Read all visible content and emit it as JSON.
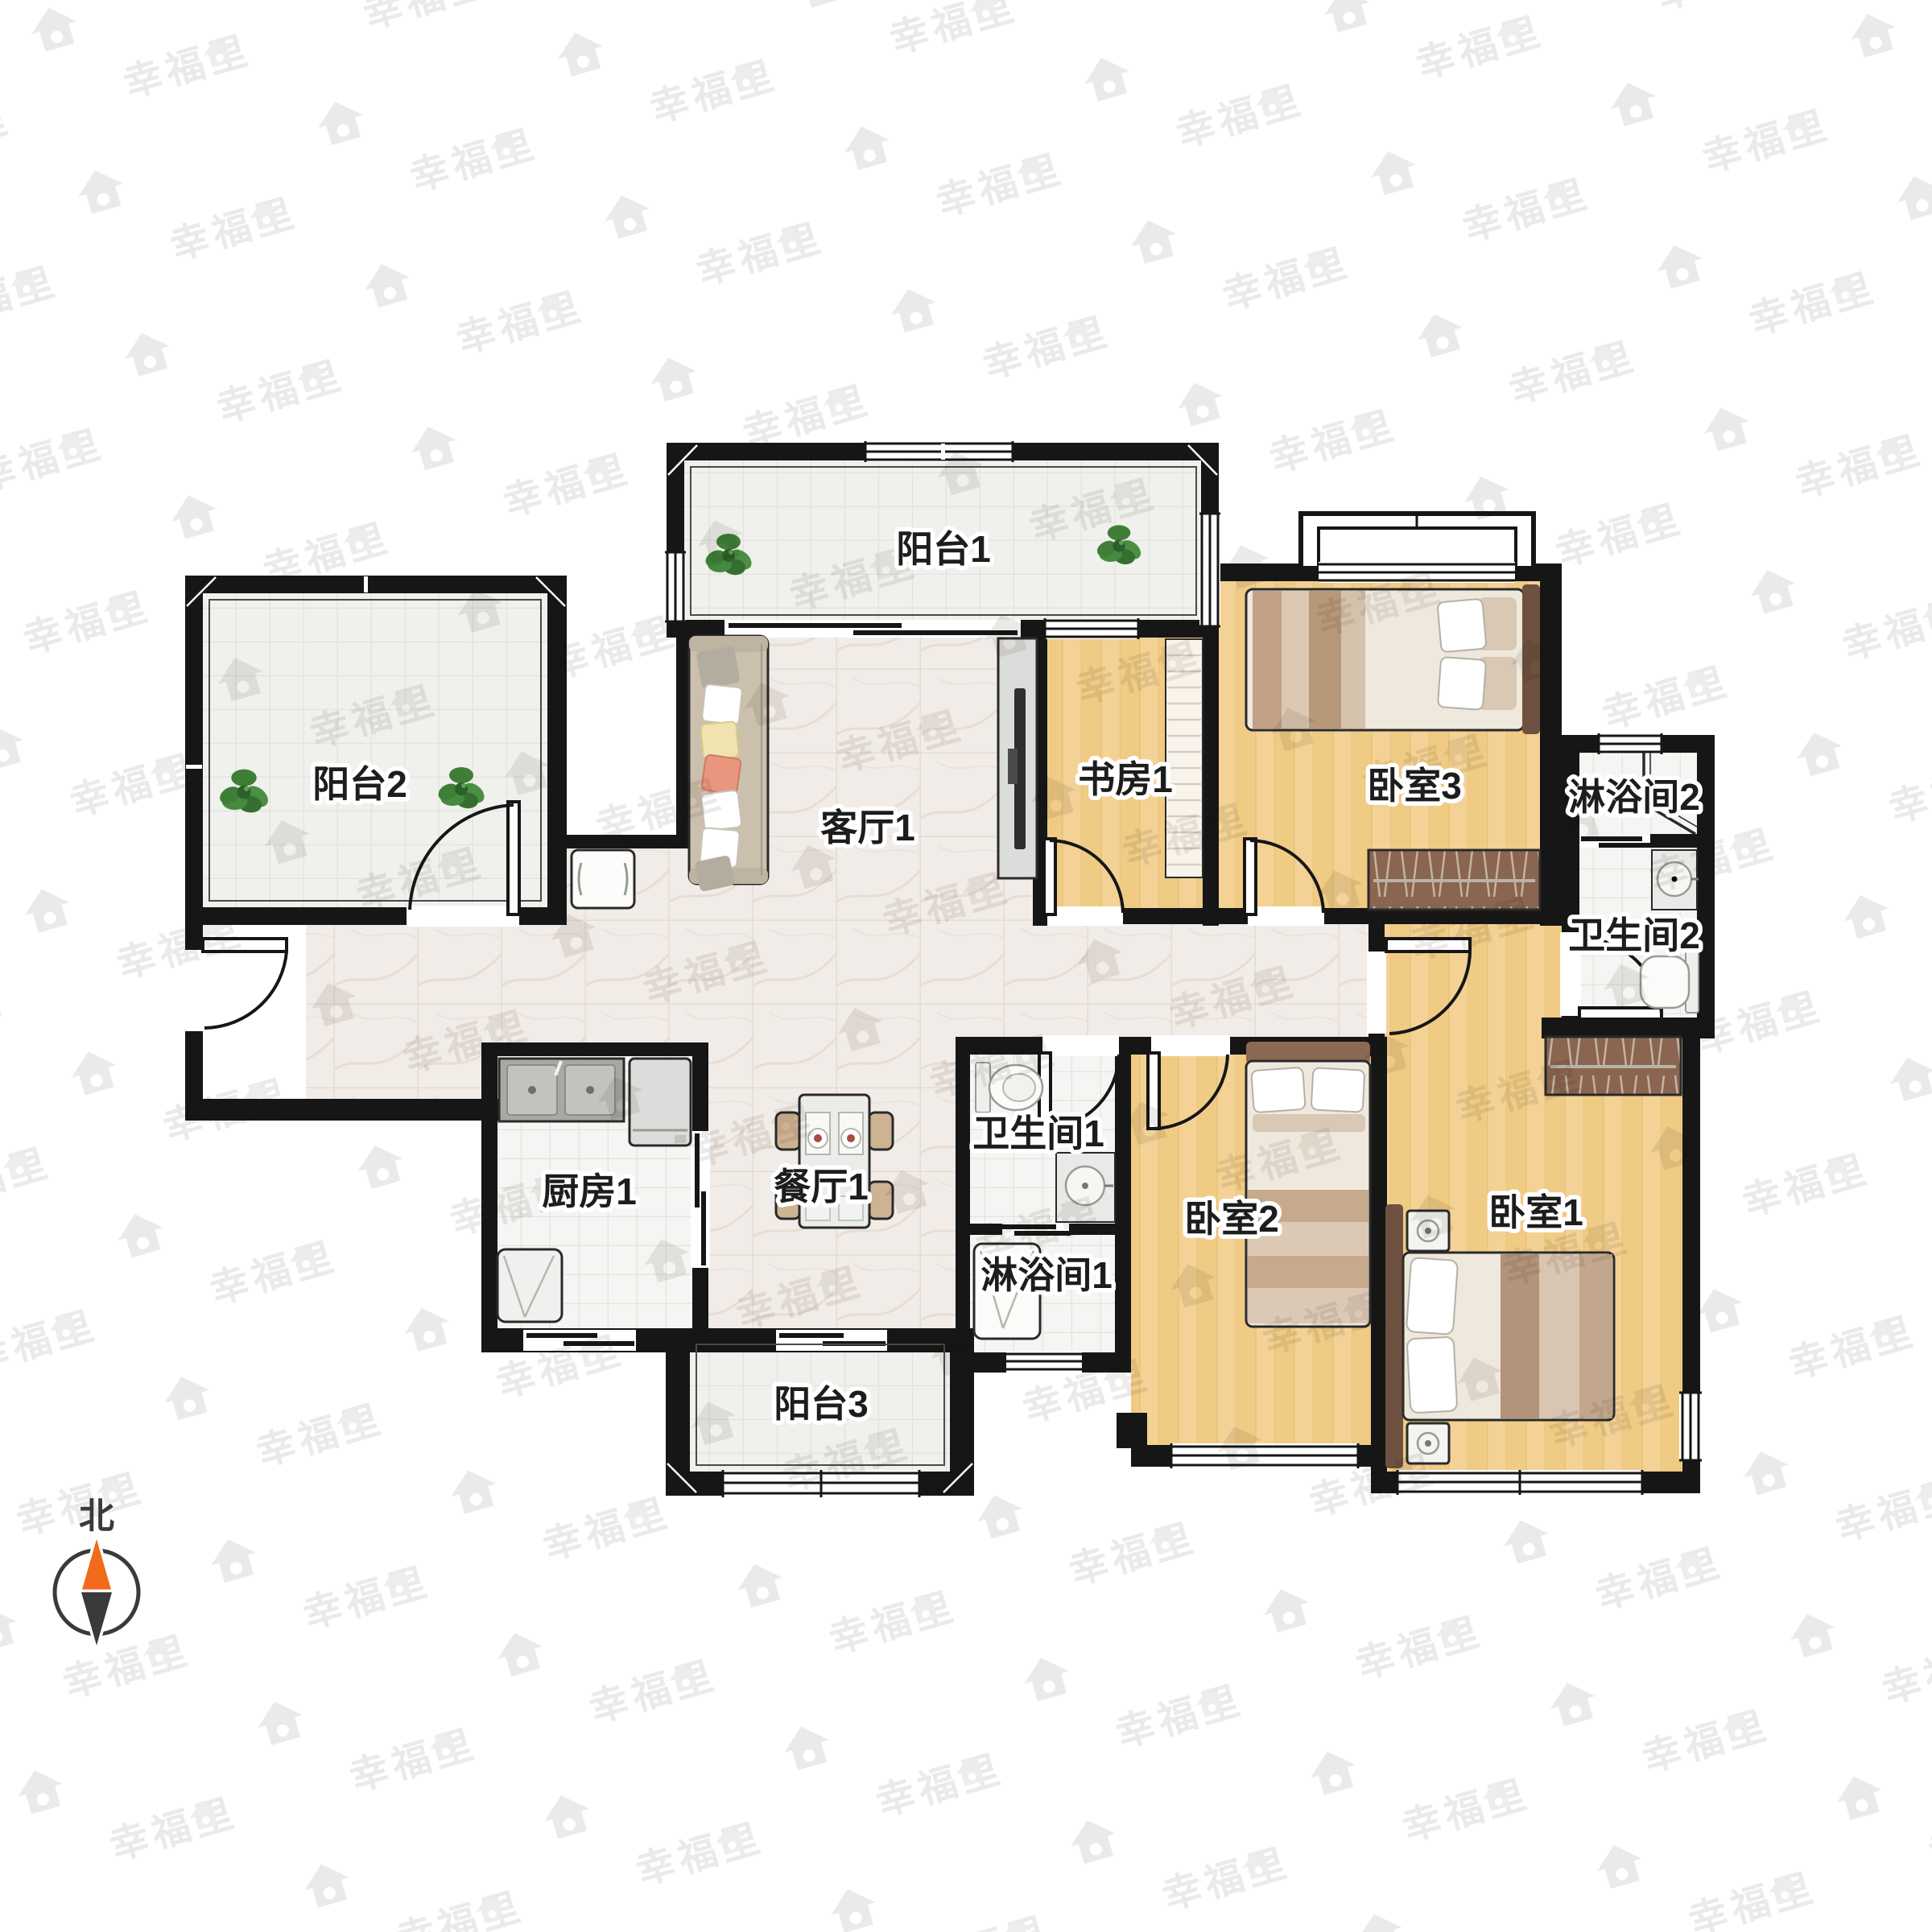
{
  "watermark": {
    "text": "幸福里"
  },
  "compass": {
    "north_label": "北",
    "arrow_up_color": "#f26a1b",
    "arrow_down_color": "#3a3a3a"
  },
  "colors": {
    "wall": "#161616",
    "wood_floor": "#f4d295",
    "wood_stripe": "#eac579",
    "marble_floor": "#f1ece7",
    "tile_floor": "#f5f5f3",
    "balcony_floor": "#f0f0ed",
    "wardrobe": "#8a6550",
    "plant": "#47893f",
    "watermark_gray": "#eceae8"
  },
  "rooms": [
    {
      "id": "balcony-1",
      "label": "阳台1"
    },
    {
      "id": "study-1",
      "label": "书房1"
    },
    {
      "id": "bedroom-3",
      "label": "卧室3"
    },
    {
      "id": "shower-room-2",
      "label": "淋浴间2"
    },
    {
      "id": "bathroom-2",
      "label": "卫生间2"
    },
    {
      "id": "balcony-2",
      "label": "阳台2"
    },
    {
      "id": "living-room-1",
      "label": "客厅1"
    },
    {
      "id": "kitchen-1",
      "label": "厨房1"
    },
    {
      "id": "dining-room-1",
      "label": "餐厅1"
    },
    {
      "id": "bathroom-1",
      "label": "卫生间1"
    },
    {
      "id": "shower-room-1",
      "label": "淋浴间1"
    },
    {
      "id": "balcony-3",
      "label": "阳台3"
    },
    {
      "id": "bedroom-2",
      "label": "卧室2"
    },
    {
      "id": "bedroom-1",
      "label": "卧室1"
    }
  ]
}
